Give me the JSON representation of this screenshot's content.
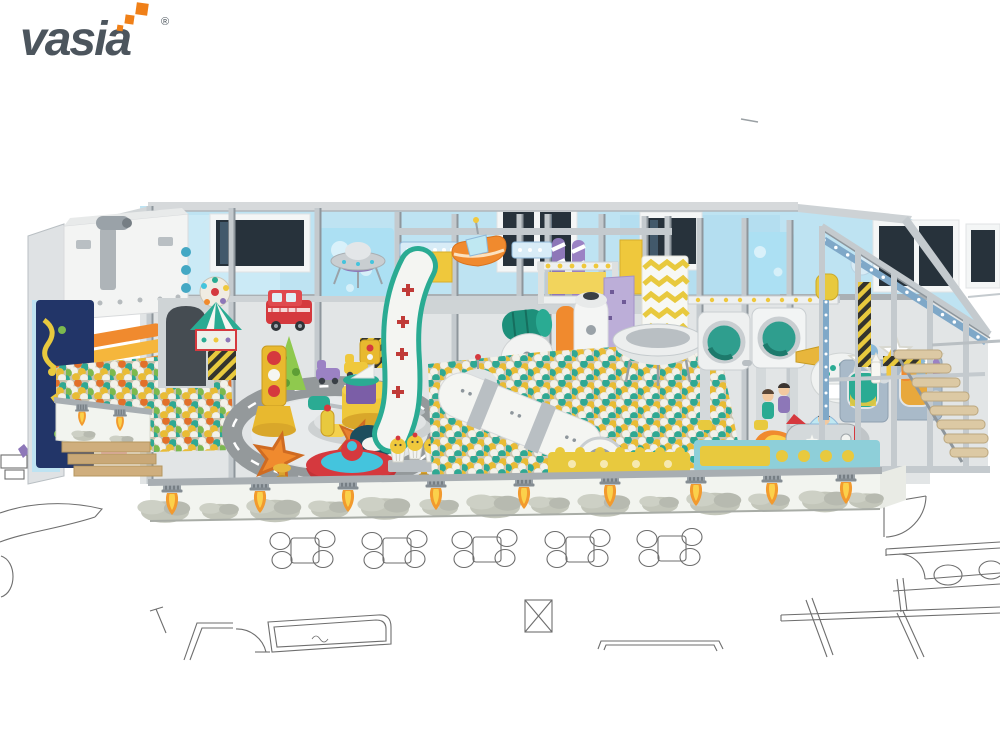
{
  "logo": {
    "brand": "vasia",
    "registered": "®"
  },
  "palette": {
    "brandOrange": "#F08018",
    "logoGray": "#4C555D",
    "steel": "#C4CACE",
    "steelDark": "#8E969C",
    "wallBlue": "#BEE3F2",
    "windowPane": "#27323B",
    "teal": "#2AAB93",
    "yellow": "#EFC83C",
    "orange": "#F08A2E",
    "red": "#D5393E",
    "cyan": "#44C4DD",
    "purple": "#8D77B8",
    "purpleLight": "#BCAED8",
    "floorGray": "#E2E5E6",
    "roadGray": "#94999B",
    "frontWall": "#F2F4EF",
    "smoke": "#C2C5BA",
    "wood": "#C9A877",
    "planLine": "#6E6E6E",
    "ballWhite": "#F2F1EA",
    "ballTeal": "#2FA893",
    "ballYellow": "#E9BC35"
  },
  "scene": {
    "kind": "indoor-playground-3d-render",
    "theme": "space",
    "elements": [
      "spaceship-cabin",
      "roller-slide",
      "left-ball-pit",
      "play-wall-panel",
      "wooden-steps",
      "rocket-print-front-wall",
      "toddler-road-ring",
      "carousel",
      "traffic-light",
      "fire-truck",
      "play-tent",
      "green-tree",
      "starfish",
      "spinning-top-ride",
      "mushroom-stools",
      "astronaut-figure",
      "wavy-slide",
      "ufo-decoration",
      "orange-boat",
      "space-shuttle",
      "candy-poles",
      "climbing-wall",
      "zigzag-curtain",
      "radar-dish",
      "control-console",
      "main-ball-pit",
      "rocket-tube-slide",
      "ufo-saucer-bowl",
      "porthole-pods",
      "dial-pod",
      "window-panels",
      "rocket-ride",
      "star-crayon-decor",
      "steel-frame",
      "hazard-columns",
      "wooden-stairs",
      "floor-plan-tables",
      "floor-plan-walls"
    ]
  }
}
